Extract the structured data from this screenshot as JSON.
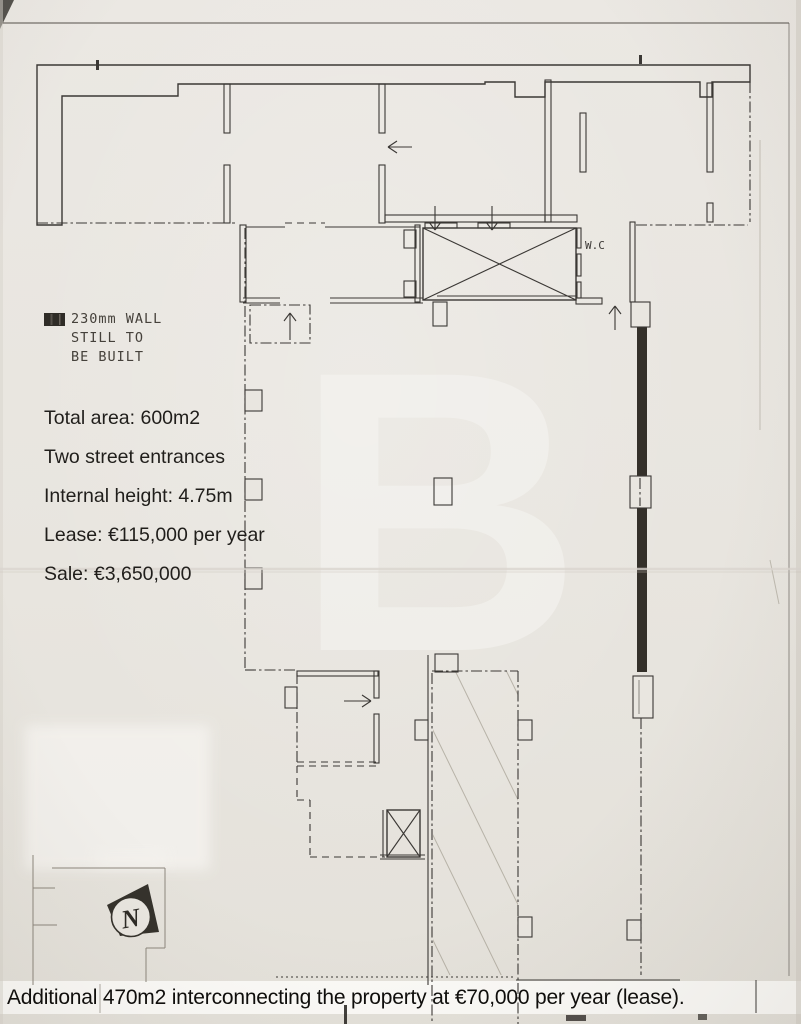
{
  "legend": {
    "lines": [
      "230mm WALL",
      "STILL TO",
      "BE BUILT"
    ]
  },
  "facts": [
    "Total area: 600m2",
    "Two street entrances",
    "Internal height: 4.75m",
    "Lease: €115,000 per year",
    "Sale: €3,650,000"
  ],
  "caption": "Additional 470m2 interconnecting the property at €70,000 per year (lease).",
  "plan": {
    "wc_label": "W.C",
    "north_label": "N",
    "watermark_letter": "B"
  },
  "colors": {
    "paper": "#e9e6e0",
    "ink": "#3b3835",
    "hatch": "#4b4742",
    "wall_dark": "#34302a",
    "faint_hatch": "#a29c90",
    "caption_bg": "#fbfaf7",
    "caption_ink": "#0e0d0b",
    "watermark": "#f6f5f2"
  }
}
